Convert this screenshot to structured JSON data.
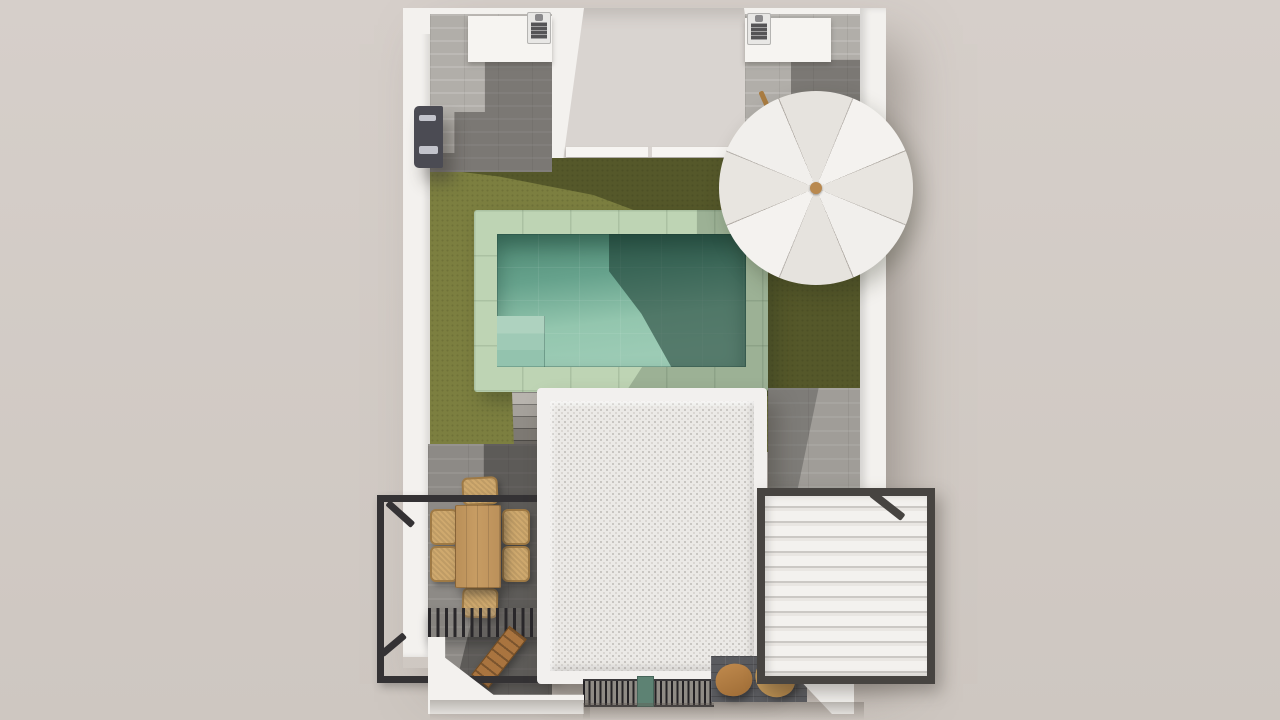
{
  "scene": {
    "description": "Top-down 3D architectural render of a villa with rooftop terraces, garden, pool and pergolas",
    "view": "top-down",
    "elements": [
      {
        "id": "house-walls",
        "label": "white perimeter walls"
      },
      {
        "id": "courtyard-recess",
        "label": "central recessed courtyard with window band"
      },
      {
        "id": "left-terrace",
        "label": "top-left roof terrace with grey plank floor"
      },
      {
        "id": "right-terrace",
        "label": "top-right roof terrace with grey plank floor"
      },
      {
        "id": "bbq-counter-left",
        "label": "white counter with barbecue grill"
      },
      {
        "id": "bbq-counter-right",
        "label": "white counter with barbecue grill"
      },
      {
        "id": "outdoor-shower",
        "label": "dark wall-mounted outdoor unit"
      },
      {
        "id": "lawn",
        "label": "olive-green artificial lawn"
      },
      {
        "id": "pool",
        "label": "swimming pool with green stone coping and steps"
      },
      {
        "id": "garden-stairs",
        "label": "grey steps from pool deck"
      },
      {
        "id": "patio-umbrella",
        "label": "white 8-panel parasol with wooden pole"
      },
      {
        "id": "flat-roof",
        "label": "white gravel flat roof with parapet"
      },
      {
        "id": "dining-set",
        "label": "wooden dining table with 6 wicker chairs"
      },
      {
        "id": "pergola-frame",
        "label": "black steel pergola frame"
      },
      {
        "id": "slatted-canopy",
        "label": "black slatted shade canopy"
      },
      {
        "id": "garden-bench",
        "label": "wooden slatted bench"
      },
      {
        "id": "louvered-pergola",
        "label": "white louvered bioclimatic pergola with dark frame"
      },
      {
        "id": "entrance-grate",
        "label": "slatted entrance grate with green planter"
      },
      {
        "id": "lounge-chairs",
        "label": "two wooden leaf-shaped lounge chairs"
      }
    ],
    "counts": {
      "dining_chairs": 6,
      "lounge_chairs": 2,
      "bbq_grills": 2,
      "umbrella_panels": 8
    }
  },
  "palette": {
    "bg1": "#d6cfca",
    "bg2": "#cec7c1",
    "wall": "#f3f1ee",
    "recess": "#d9d4d0",
    "sill": "#f7f5f2",
    "plankLight": "#b1aea9",
    "plankDeck": "#8d8a86",
    "deckRight": "#a09d98",
    "counter": "#f6f4f1",
    "grill": "#555456",
    "shower": "#4b4b53",
    "lawn": "#7c7f40",
    "poolDeck": "#bed4b4",
    "waterDeep": "#4f8974",
    "waterMid": "#66a28c",
    "waterLight": "#93c6ae",
    "umbrella1": "#f4f2ef",
    "umbrella2": "#e8e5e0",
    "knob": "#b9894f",
    "roofBorder": "#f2f0ee",
    "roofFill": "#ebe9e6",
    "roofSpeckle": "#c6c3bf",
    "frameDark": "#343234",
    "louverFrame": "#474441",
    "louverLight": "#f3f1ee",
    "louverShade": "#cbc8c4",
    "wood": "#c79c63",
    "wicker": "#cfa96e",
    "wickerEdge": "#9f7a45",
    "bench": "#a9743f",
    "leafChair": "#bd8a4f",
    "darkTile": "#5a5b5f",
    "grateBg": "#8f8b85",
    "grateSlat": "#232124",
    "greenBox": "#5d8273",
    "stick": "#a97c42"
  }
}
